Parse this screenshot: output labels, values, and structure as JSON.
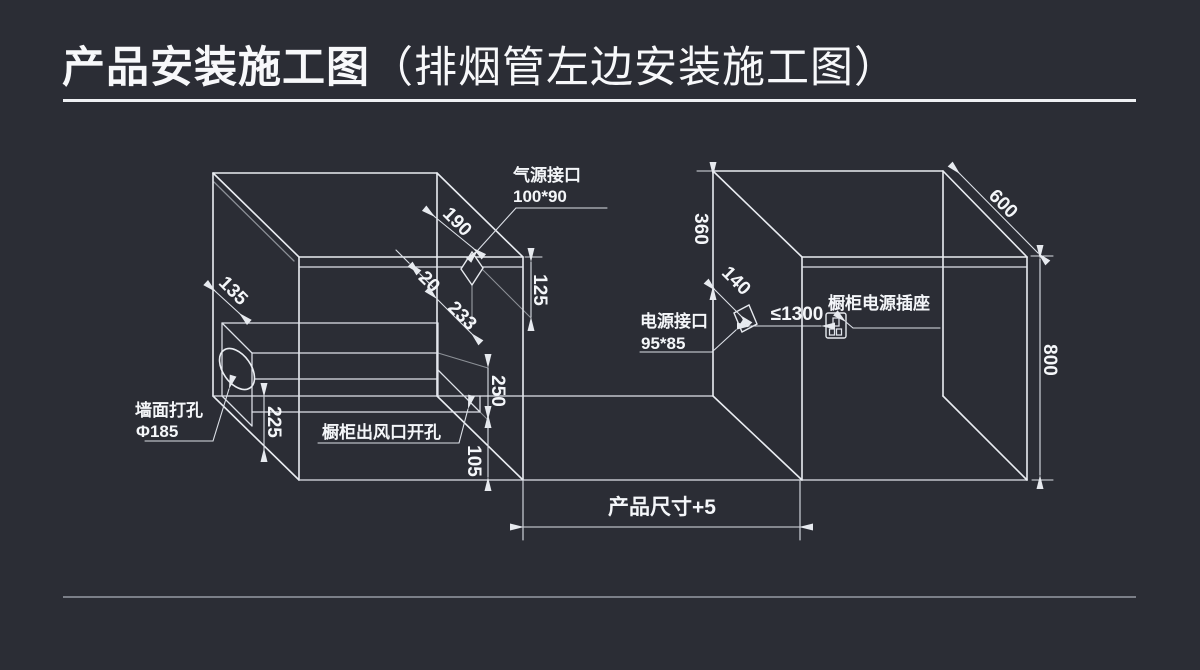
{
  "title": {
    "main": "产品安装施工图",
    "sub": "（排烟管左边安装施工图）"
  },
  "left_cabinet": {
    "gas_port": {
      "line1": "气源接口",
      "line2": "100*90"
    },
    "wall_hole": {
      "line1": "墙面打孔",
      "line2": "Φ185"
    },
    "vent_cutout_label": "橱柜出风口开孔",
    "dims": {
      "d190": "190",
      "d125": "125",
      "d20": "20",
      "d233": "233",
      "d250": "250",
      "d105": "105",
      "d135": "135",
      "d225": "225"
    }
  },
  "right_cabinet": {
    "power_port": {
      "line1": "电源接口",
      "line2": "95*85"
    },
    "socket_label": "橱柜电源插座",
    "dims": {
      "d360": "360",
      "d140": "140",
      "d1300": "≤1300",
      "d600": "600",
      "d800": "800"
    }
  },
  "bottom_dim_label": "产品尺寸+5",
  "colors": {
    "background": "#2b2d35",
    "line": "#e7eaef",
    "text": "#f4f6f9",
    "title_rule": "#eef0f3",
    "footer_rule": "#7b7f88"
  }
}
